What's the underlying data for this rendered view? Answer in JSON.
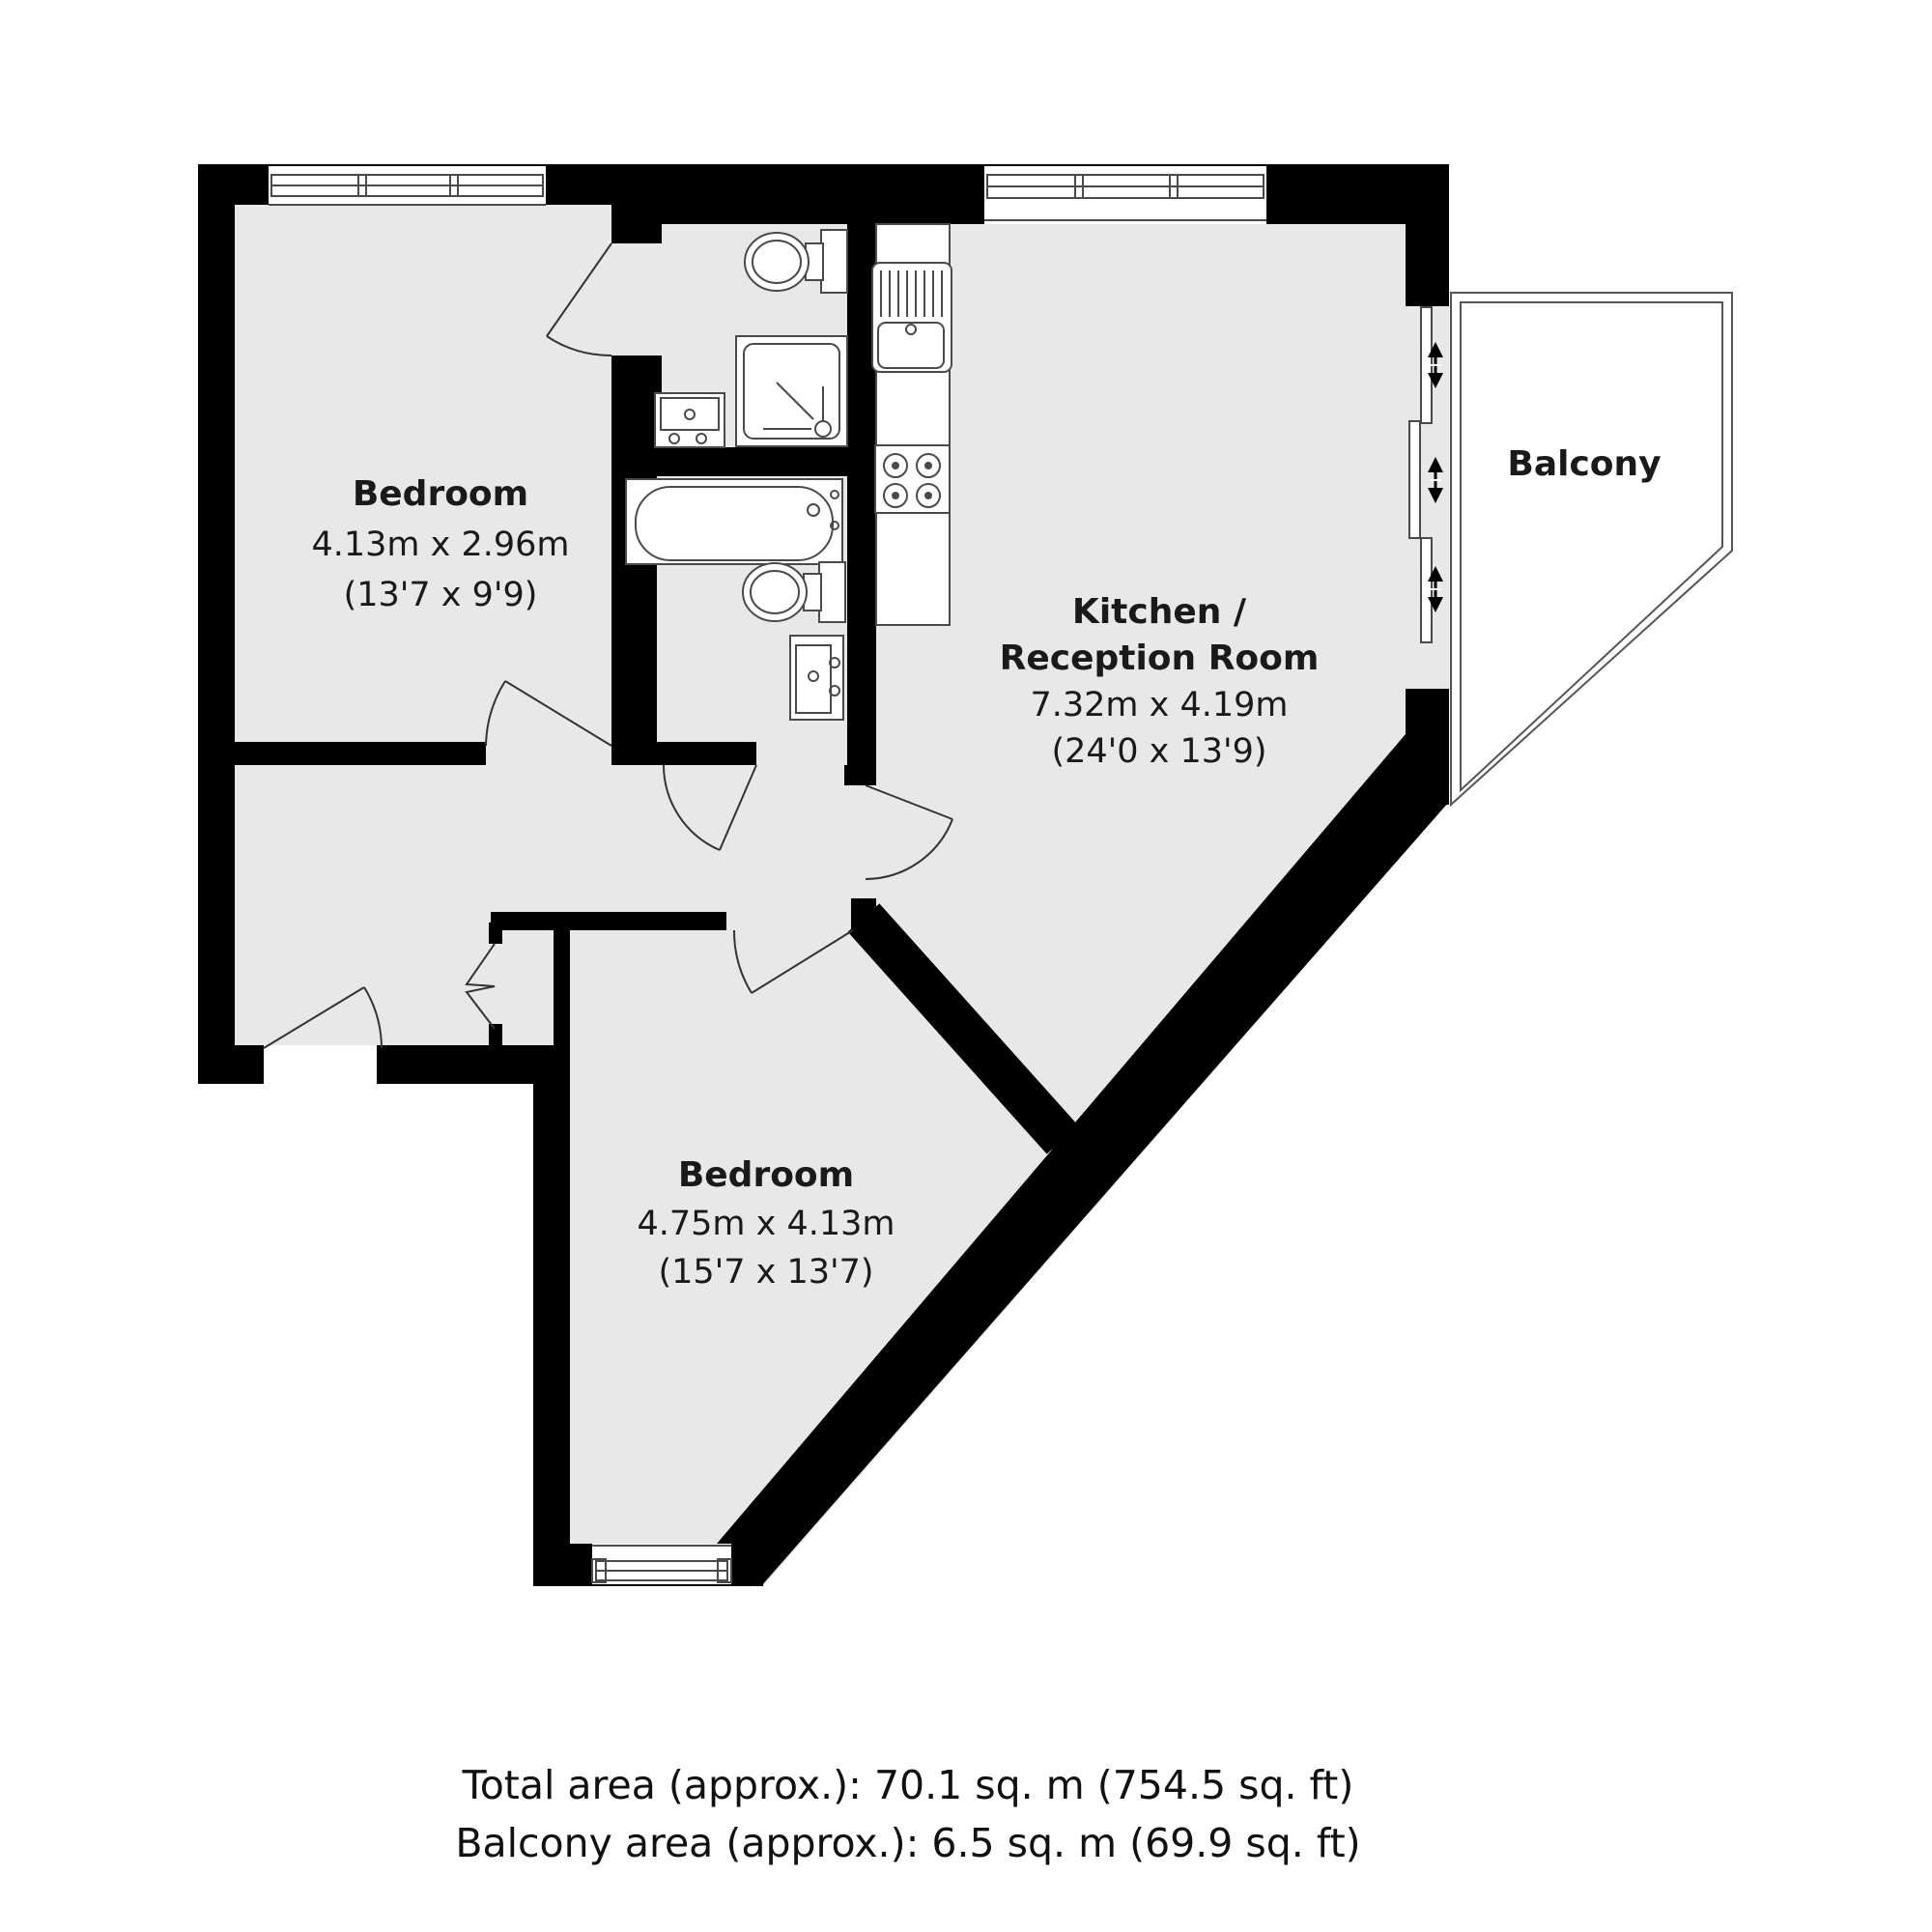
{
  "plan": {
    "rooms": [
      {
        "id": "bedroom-1",
        "name": "Bedroom",
        "dimensions_metric": "4.13m x 2.96m",
        "dimensions_imperial": "(13'7 x 9'9)"
      },
      {
        "id": "kitchen-reception",
        "name_line1": "Kitchen /",
        "name_line2": "Reception Room",
        "dimensions_metric": "7.32m x 4.19m",
        "dimensions_imperial": "(24'0 x 13'9)"
      },
      {
        "id": "bedroom-2",
        "name": "Bedroom",
        "dimensions_metric": "4.75m x 4.13m",
        "dimensions_imperial": "(15'7 x 13'7)"
      }
    ],
    "balcony": {
      "label": "Balcony"
    },
    "footer": {
      "total_area": "Total area (approx.): 70.1 sq. m (754.5 sq. ft)",
      "balcony_area": "Balcony area (approx.): 6.5 sq. m (69.9 sq. ft)"
    },
    "fixtures": [
      "toilet",
      "shower",
      "sink-vanity",
      "bath",
      "toilet",
      "sink-vanity",
      "kitchen-sink-drainer",
      "hob-4-burner",
      "kitchen-counter"
    ],
    "symbols": [
      "window",
      "door-swing-arc",
      "bifold-door",
      "sliding-door-arrow",
      "balcony-railing"
    ],
    "colors": {
      "wall": "#000000",
      "floor": "#e8e8e8",
      "background": "#ffffff",
      "fixture_stroke": "#4a4a4a"
    }
  }
}
